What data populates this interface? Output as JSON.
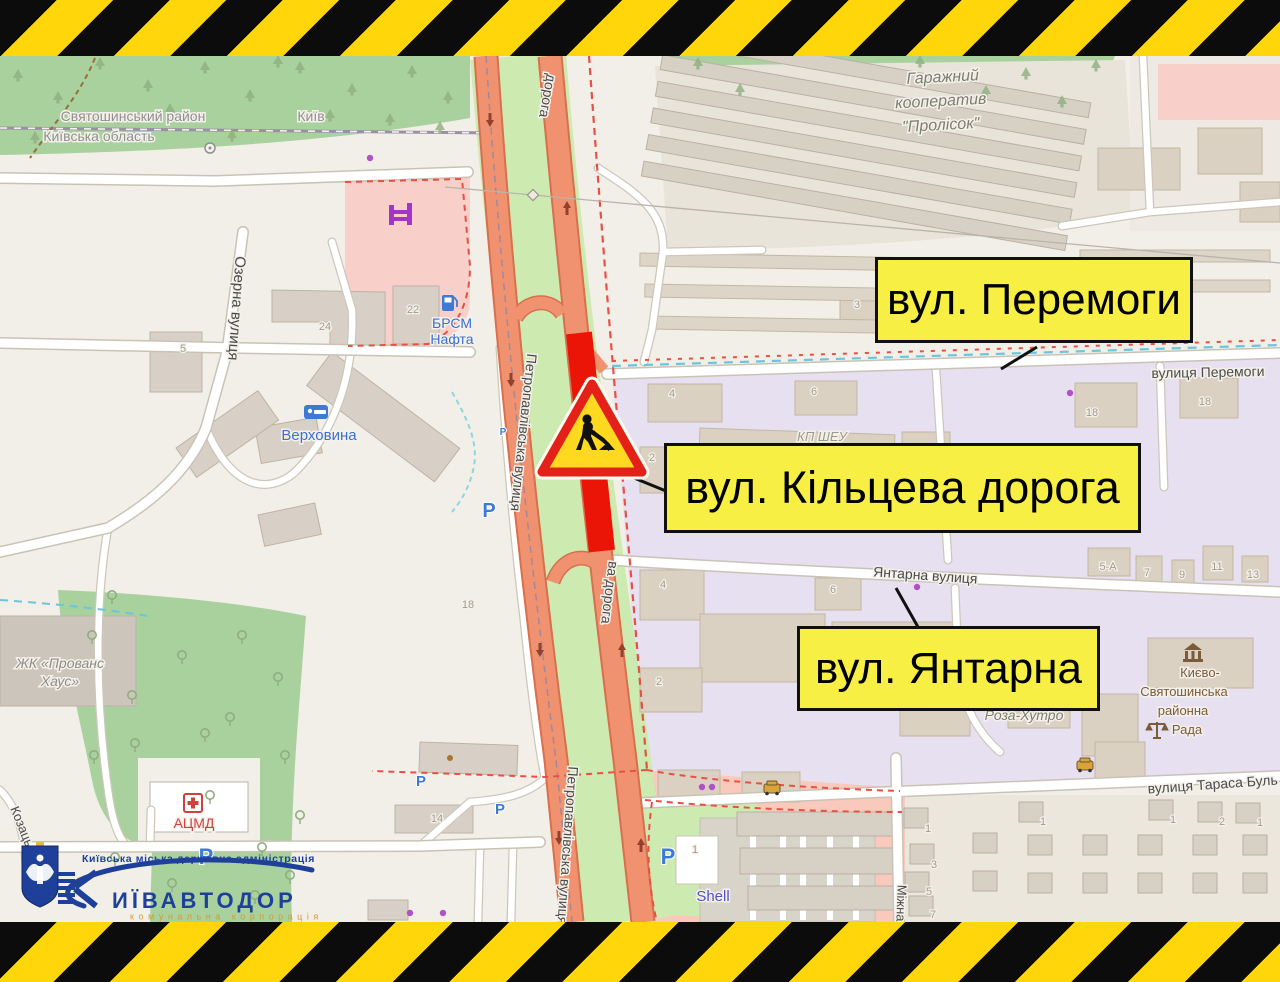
{
  "callouts": {
    "peremohy": {
      "label": "вул. Перемоги"
    },
    "kiltseva": {
      "label": "вул. Кільцева дорога"
    },
    "yantarna": {
      "label": "вул. Янтарна"
    }
  },
  "logo": {
    "admin_line": "Київська міська державна адміністрація",
    "wordmark_initial": "К",
    "wordmark_rest": "ИЇВАВТОДОР",
    "subtitle": "комунальна корпорація"
  },
  "street_labels": [
    {
      "text": "Святошинський район",
      "x": 133,
      "y": 121,
      "size": 14,
      "color": "#8f8f8f"
    },
    {
      "text": "Київ",
      "x": 311,
      "y": 121,
      "size": 14,
      "color": "#8f8f8f"
    },
    {
      "text": "Київська область",
      "x": 99,
      "y": 141,
      "size": 14,
      "color": "#8f8f8f"
    },
    {
      "text": "Озерна вулиця",
      "x": 232,
      "y": 308,
      "rot": 94,
      "size": 15,
      "color": "#4a4a4a"
    },
    {
      "text": "Петропавлівська вулиця",
      "x": 519,
      "y": 432,
      "rot": 96,
      "size": 14,
      "color": "#4a4a4a"
    },
    {
      "text": "Петропавлівська вулиця",
      "x": 563,
      "y": 845,
      "rot": 94,
      "size": 14,
      "color": "#4a4a4a"
    },
    {
      "text": "дорога",
      "x": 543,
      "y": 95,
      "rot": 100,
      "size": 14,
      "color": "#4a4a4a"
    },
    {
      "text": "ва дорога",
      "x": 605,
      "y": 592,
      "rot": 97,
      "size": 14,
      "color": "#4a4a4a"
    },
    {
      "text": "вулиця Перемоги",
      "x": 1208,
      "y": 377,
      "rot": -1,
      "size": 14,
      "color": "#4a4a4a"
    },
    {
      "text": "Янтарна вулиця",
      "x": 925,
      "y": 580,
      "rot": 4,
      "size": 14,
      "color": "#4a4a4a"
    },
    {
      "text": "вулиця Тараса Буль",
      "x": 1213,
      "y": 789,
      "rot": -4,
      "size": 14,
      "color": "#4a4a4a"
    },
    {
      "text": "Міжна",
      "x": 897,
      "y": 903,
      "rot": 92,
      "size": 13,
      "color": "#4a4a4a"
    },
    {
      "text": "Козаць",
      "x": 18,
      "y": 828,
      "rot": 68,
      "size": 13,
      "color": "#4a4a4a"
    },
    {
      "text": "Гаражний",
      "x": 943,
      "y": 82,
      "rot": -3,
      "size": 16,
      "italic": true,
      "color": "#7d7d6e"
    },
    {
      "text": "кооператив",
      "x": 941,
      "y": 106,
      "rot": -3,
      "size": 16,
      "italic": true,
      "color": "#7d7d6e"
    },
    {
      "text": "\"Пролісок\"",
      "x": 941,
      "y": 130,
      "rot": -3,
      "size": 16,
      "italic": true,
      "color": "#7d7d6e"
    },
    {
      "text": "КП ШЕУ",
      "x": 822,
      "y": 441,
      "size": 13,
      "italic": true,
      "color": "#9a9a8a"
    },
    {
      "text": "Роза-Хутро",
      "x": 1024,
      "y": 720,
      "size": 14,
      "italic": true,
      "color": "#7d7d6e"
    },
    {
      "text": "Києво-",
      "x": 1200,
      "y": 677,
      "size": 13,
      "color": "#7a5b3a"
    },
    {
      "text": "Святошинська",
      "x": 1184,
      "y": 696,
      "size": 13,
      "color": "#7a5b3a"
    },
    {
      "text": "районна",
      "x": 1183,
      "y": 715,
      "size": 13,
      "color": "#7a5b3a"
    },
    {
      "text": "Рада",
      "x": 1187,
      "y": 734,
      "size": 13,
      "color": "#7a5b3a"
    },
    {
      "text": "БРСМ",
      "x": 452,
      "y": 328,
      "size": 14,
      "color": "#3c6fd1"
    },
    {
      "text": "Нафта",
      "x": 452,
      "y": 344,
      "size": 14,
      "color": "#3c6fd1"
    },
    {
      "text": "Верховина",
      "x": 319,
      "y": 440,
      "size": 15,
      "color": "#3c6fd1"
    },
    {
      "text": "ЖК «Прованс",
      "x": 60,
      "y": 668,
      "size": 14,
      "italic": true,
      "color": "#8d8d86"
    },
    {
      "text": "Хаус»",
      "x": 60,
      "y": 686,
      "size": 14,
      "italic": true,
      "color": "#8d8d86"
    },
    {
      "text": "АЦМД",
      "x": 194,
      "y": 828,
      "size": 14,
      "color": "#d23f3f"
    },
    {
      "text": "Shell",
      "x": 713,
      "y": 901,
      "size": 15,
      "color": "#5050c8"
    }
  ],
  "house_numbers": [
    {
      "t": "5",
      "x": 183,
      "y": 352
    },
    {
      "t": "24",
      "x": 325,
      "y": 330
    },
    {
      "t": "22",
      "x": 413,
      "y": 313
    },
    {
      "t": "18",
      "x": 468,
      "y": 608
    },
    {
      "t": "3",
      "x": 857,
      "y": 308
    },
    {
      "t": "4",
      "x": 672,
      "y": 397
    },
    {
      "t": "6",
      "x": 814,
      "y": 395
    },
    {
      "t": "2",
      "x": 652,
      "y": 461
    },
    {
      "t": "4",
      "x": 663,
      "y": 588
    },
    {
      "t": "6",
      "x": 833,
      "y": 593
    },
    {
      "t": "2",
      "x": 659,
      "y": 685
    },
    {
      "t": "18",
      "x": 1092,
      "y": 416
    },
    {
      "t": "18",
      "x": 1205,
      "y": 405
    },
    {
      "t": "5-А",
      "x": 1108,
      "y": 570
    },
    {
      "t": "7",
      "x": 1147,
      "y": 576
    },
    {
      "t": "9",
      "x": 1182,
      "y": 578
    },
    {
      "t": "11",
      "x": 1217,
      "y": 570
    },
    {
      "t": "13",
      "x": 1253,
      "y": 578
    },
    {
      "t": "1",
      "x": 928,
      "y": 832
    },
    {
      "t": "3",
      "x": 934,
      "y": 868
    },
    {
      "t": "5",
      "x": 929,
      "y": 895
    },
    {
      "t": "7",
      "x": 933,
      "y": 918
    },
    {
      "t": "1",
      "x": 1043,
      "y": 825
    },
    {
      "t": "1",
      "x": 1173,
      "y": 823
    },
    {
      "t": "2",
      "x": 1222,
      "y": 825
    },
    {
      "t": "1",
      "x": 1260,
      "y": 826
    },
    {
      "t": "1",
      "x": 695,
      "y": 853
    },
    {
      "t": "14",
      "x": 437,
      "y": 822
    }
  ],
  "icons": {
    "parking": [
      {
        "x": 489,
        "y": 517,
        "s": 20
      },
      {
        "x": 421,
        "y": 786,
        "s": 15
      },
      {
        "x": 500,
        "y": 814,
        "s": 15
      },
      {
        "x": 668,
        "y": 864,
        "s": 22
      },
      {
        "x": 206,
        "y": 864,
        "s": 22
      },
      {
        "x": 613,
        "y": 478,
        "s": 10
      },
      {
        "x": 503,
        "y": 435,
        "s": 10
      }
    ],
    "fuel": [
      {
        "x": 448,
        "y": 303
      },
      {
        "x": 697,
        "y": 872
      }
    ],
    "purple_dots": [
      [
        370,
        158
      ],
      [
        410,
        913
      ],
      [
        917,
        587
      ],
      [
        1070,
        393
      ],
      [
        702,
        787
      ],
      [
        712,
        787
      ],
      [
        443,
        913
      ]
    ],
    "brown_dots": [
      [
        450,
        758
      ]
    ]
  },
  "vegetation": {
    "conifer": [
      [
        18,
        78
      ],
      [
        58,
        100
      ],
      [
        100,
        66
      ],
      [
        148,
        88
      ],
      [
        205,
        70
      ],
      [
        250,
        98
      ],
      [
        300,
        70
      ],
      [
        352,
        92
      ],
      [
        412,
        74
      ],
      [
        170,
        112
      ],
      [
        330,
        118
      ],
      [
        390,
        122
      ],
      [
        448,
        100
      ],
      [
        35,
        140
      ],
      [
        232,
        138
      ],
      [
        118,
        120
      ],
      [
        278,
        64
      ],
      [
        440,
        130
      ],
      [
        698,
        66
      ],
      [
        740,
        92
      ],
      [
        986,
        94
      ],
      [
        1026,
        76
      ],
      [
        1062,
        104
      ],
      [
        1096,
        68
      ],
      [
        920,
        64
      ]
    ],
    "deciduous": [
      [
        92,
        640
      ],
      [
        132,
        700
      ],
      [
        182,
        660
      ],
      [
        230,
        722
      ],
      [
        278,
        682
      ],
      [
        135,
        748
      ],
      [
        210,
        800
      ],
      [
        115,
        862
      ],
      [
        262,
        852
      ],
      [
        94,
        760
      ],
      [
        172,
        888
      ],
      [
        242,
        640
      ],
      [
        285,
        760
      ],
      [
        300,
        820
      ],
      [
        112,
        600
      ],
      [
        205,
        738
      ],
      [
        255,
        900
      ],
      [
        290,
        880
      ]
    ]
  },
  "oneway": {
    "down": [
      [
        490,
        120
      ],
      [
        511,
        380
      ],
      [
        540,
        650
      ],
      [
        559,
        838
      ]
    ],
    "up": [
      [
        567,
        208
      ],
      [
        622,
        650
      ],
      [
        641,
        845
      ]
    ]
  },
  "garage_cells": [
    [
      916,
      818
    ],
    [
      922,
      854
    ],
    [
      917,
      882
    ],
    [
      921,
      906
    ],
    [
      1031,
      812
    ],
    [
      985,
      843
    ],
    [
      985,
      881
    ],
    [
      1040,
      845
    ],
    [
      1040,
      883
    ],
    [
      1095,
      845
    ],
    [
      1095,
      883
    ],
    [
      1161,
      810
    ],
    [
      1150,
      845
    ],
    [
      1150,
      883
    ],
    [
      1210,
      812
    ],
    [
      1205,
      845
    ],
    [
      1205,
      883
    ],
    [
      1248,
      813
    ],
    [
      1255,
      845
    ],
    [
      1255,
      883
    ]
  ],
  "colors": {
    "hazard_yellow": "#ffd60a",
    "hazard_black": "#0c0c0c",
    "callout_yellow": "#f8ef45",
    "closure_red": "#ea1507",
    "road_salmon": "#f0926f",
    "forest_green": "#a9d19d",
    "median_grass": "#cdebb0",
    "industrial_lavender": "#e7e0f0",
    "retail_pink": "#f8cfc9",
    "logo_blue": "#1e3f9a",
    "logo_orange": "#d79a2e",
    "sign_yellow": "#ffd91f",
    "sign_red": "#e32119"
  }
}
